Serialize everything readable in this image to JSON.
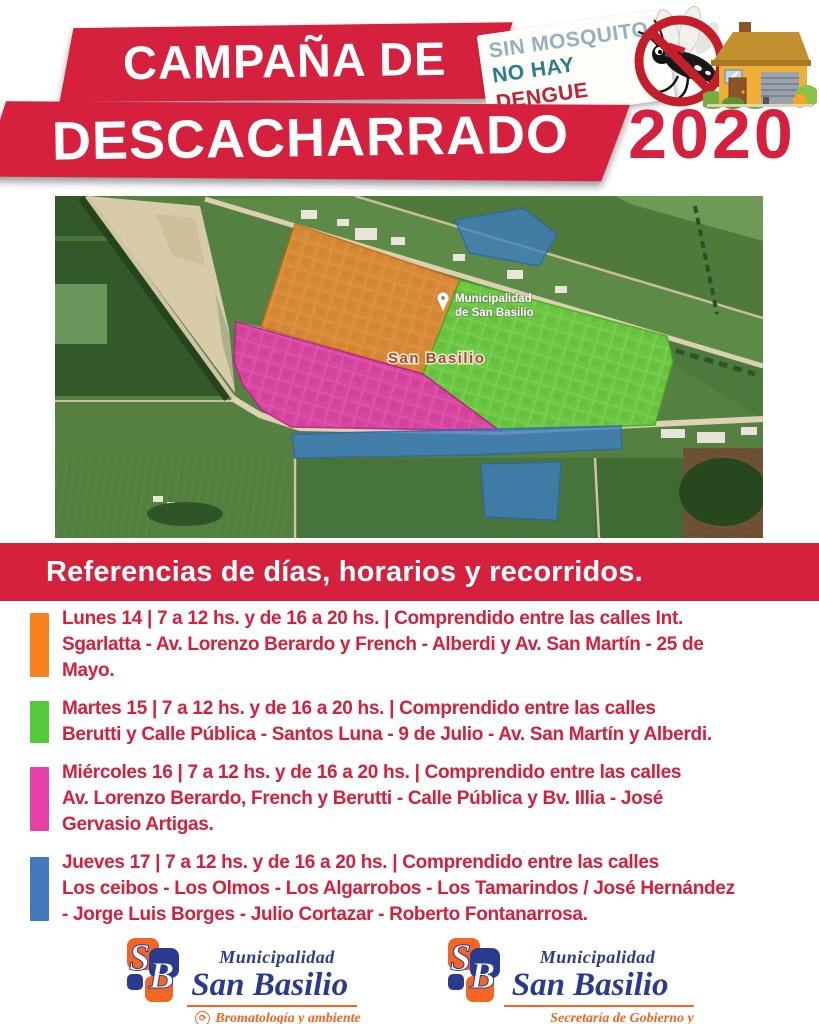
{
  "header": {
    "title_line1": "CAMPAÑA DE",
    "title_line2": "DESCACHARRADO",
    "year": "2020",
    "badge": {
      "line1": "SIN MOSQUITO",
      "line2_no_hay": "NO HAY ",
      "line2_dengue": "DENGUE"
    }
  },
  "map": {
    "pin_label_line1": "Municipalidad",
    "pin_label_line2": "de San Basilio",
    "town_label": "San Basilio",
    "zones": {
      "orange": "#e0801f",
      "green": "#4fd024",
      "magenta": "#e322a8",
      "blue": "#3c7ec4"
    }
  },
  "references": {
    "title": "Referencias de días, horarios y recorridos.",
    "items": [
      {
        "zone": "orange",
        "color": "#f5821f",
        "lines": [
          "Lunes 14 | 7 a 12 hs. y de 16 a 20 hs. | Comprendido entre las calles Int.",
          "Sgarlatta - Av. Lorenzo Berardo y French - Alberdi y Av. San Martín - 25 de",
          "Mayo."
        ]
      },
      {
        "zone": "green",
        "color": "#54c93c",
        "lines": [
          "Martes 15 | 7 a 12 hs. y de 16 a 20 hs. | Comprendido entre las calles",
          "Berutti y Calle Pública - Santos Luna - 9 de Julio - Av. San Martín y Alberdi."
        ]
      },
      {
        "zone": "magenta",
        "color": "#e63fa8",
        "lines": [
          "Miércoles 16 | 7 a 12 hs. y de 16 a 20 hs. | Comprendido entre las calles",
          "Av. Lorenzo Berardo, French y Berutti - Calle Pública y Bv. Illia - José",
          "Gervasio Artigas."
        ]
      },
      {
        "zone": "blue",
        "color": "#4479be",
        "lines": [
          "Jueves 17 | 7 a 12 hs. y de 16 a 20 hs. | Comprendido entre las calles",
          "Los ceibos - Los Olmos - Los Algarrobos - Los Tamarindos / José Hernández",
          "- Jorge Luis Borges - Julio Cortazar - Roberto Fontanarrosa."
        ]
      }
    ]
  },
  "footer": {
    "logos": [
      {
        "org_top": "Municipalidad",
        "org_name": "San Basilio",
        "dept": "Bromatología y ambiente"
      },
      {
        "org_top": "Municipalidad",
        "org_name": "San Basilio",
        "dept_line1": "Secretaría de Gobierno y",
        "dept_line2": "Servicios Municipales"
      }
    ]
  },
  "colors": {
    "brand_red": "#d6213e",
    "logo_blue": "#2a3b8f",
    "logo_orange": "#f26522"
  }
}
